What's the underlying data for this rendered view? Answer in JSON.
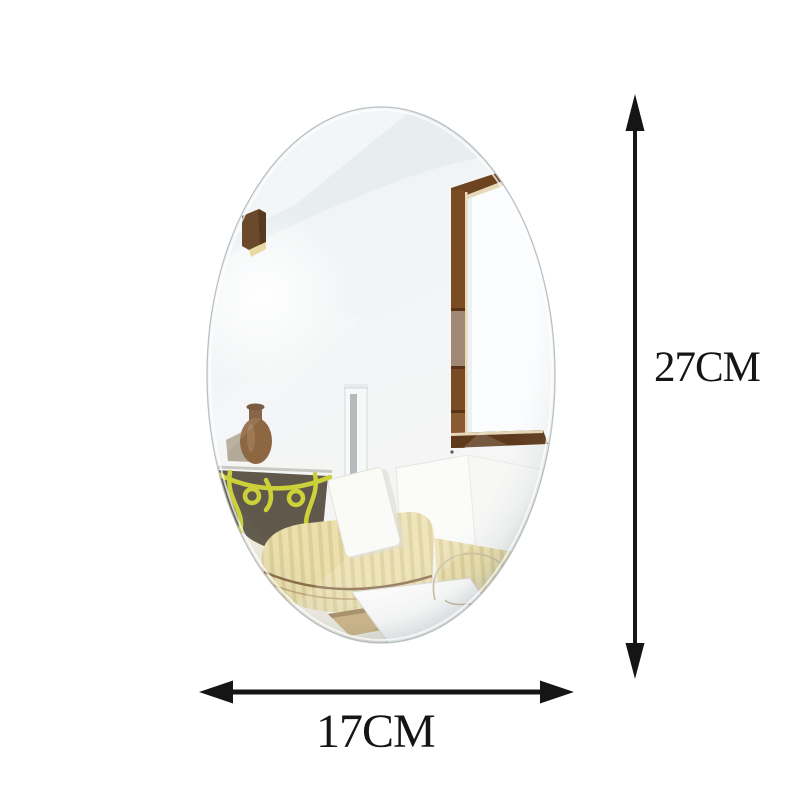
{
  "figure": {
    "height_dimension": {
      "label": "27CM"
    },
    "width_dimension": {
      "label": "17CM"
    },
    "colors": {
      "arrow": "#151515",
      "label_text": "#151515",
      "background": "#ffffff",
      "mirror_edge": "#aeb5b9",
      "ceiling": "#e8edf0",
      "wall": "#f2f4f5",
      "window_wood": "#7b4b24",
      "sofa_fabric": "#ecdfad",
      "sofa_stripe": "#dccf97",
      "iron_table_yellow": "#ccd13a",
      "vase_brown": "#8d6742",
      "floor": "#f0ebdf"
    }
  }
}
